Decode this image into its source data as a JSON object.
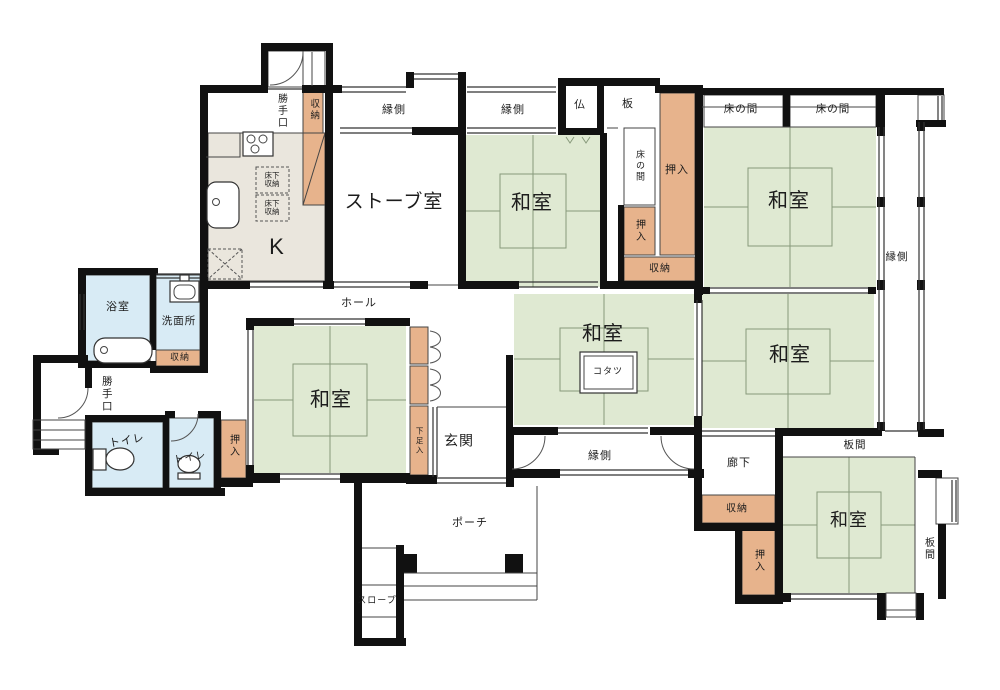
{
  "palette": {
    "tatami": "#dfe9d2",
    "closet": "#e7b38c",
    "water": "#d8ebf5",
    "kitchen_floor": "#eae6dd",
    "wall": "#111111",
    "thin_line": "#444444",
    "tatami_line": "#87997b"
  },
  "labels": {
    "katteguchi_top": "勝手口",
    "shuno_top": "収納",
    "engawa_top_1": "縁側",
    "engawa_top_2": "縁側",
    "butsu": "仏",
    "ita": "板",
    "tokonoma_mid": "床の間",
    "oshiire_mid_small": "押入",
    "oshiire_mid_big": "押入",
    "shuno_mid": "収納",
    "tokonoma_right_1": "床の間",
    "tokonoma_right_2": "床の間",
    "washitsu_mid_top": "和室",
    "washitsu_top_right": "和室",
    "washitsu_right_center": "和室",
    "washitsu_center": "和室",
    "washitsu_left": "和室",
    "washitsu_bottom_right": "和室",
    "stove_room": "ストーブ室",
    "kitchen": "K",
    "yukashita_1": "床下収納",
    "yukashita_2": "床下収納",
    "engawa_right": "縁側",
    "engawa_bottom": "縁側",
    "yokushitsu": "浴室",
    "senmenjo": "洗面所",
    "shuno_senmenjo": "収納",
    "katteguchi_left": "勝手口",
    "hall": "ホール",
    "kotatsu": "コタツ",
    "toilet_1": "トイレ",
    "toilet_2": "トイレ",
    "oshiire_left": "押入",
    "getabako": "下足入",
    "genkan": "玄関",
    "roka": "廊下",
    "shuno_bottom_right": "収納",
    "oshiire_bottom_right": "押入",
    "itama_top": "板間",
    "itama_right": "板間",
    "porch": "ポーチ",
    "slope": "スロープ"
  }
}
